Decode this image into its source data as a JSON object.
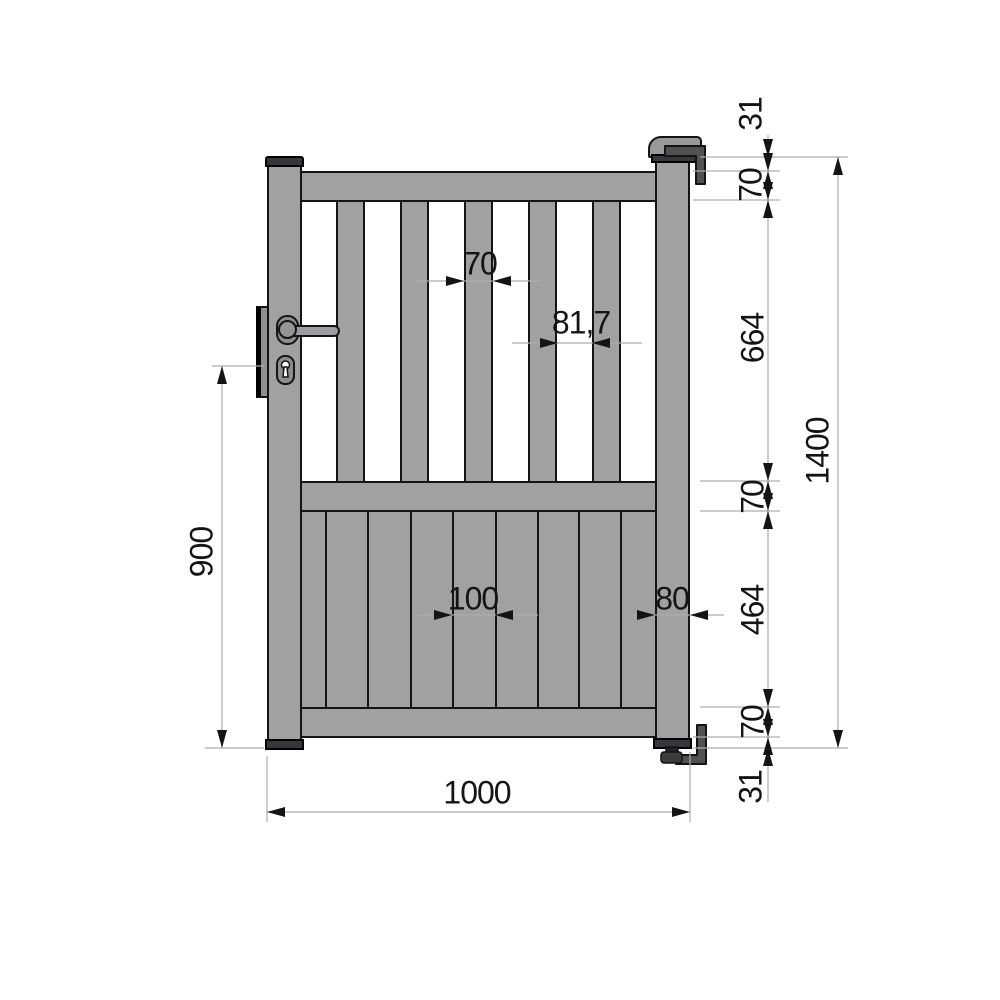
{
  "drawing": {
    "type": "technical-drawing",
    "subject": "single pedestrian gate, front elevation with dimensions",
    "units": "mm",
    "dim_labels": {
      "slat_width": "70",
      "slat_gap": "81,7",
      "board_width": "100",
      "stile_width": "80",
      "overall_width": "1000",
      "handle_height": "900",
      "overall_height": "1400",
      "top_offset": "31",
      "top_rail": "70",
      "upper_section": "664",
      "middle_rail": "70",
      "lower_section": "464",
      "bottom_rail": "70",
      "bottom_offset": "31"
    },
    "colors": {
      "gate_fill": "#9fa1a3",
      "hardware_dark": "#35373a",
      "bracket_fill": "#4f5153",
      "outline": "#141414",
      "dim_line": "#adadad",
      "text": "#141414",
      "background": "#ffffff"
    }
  }
}
